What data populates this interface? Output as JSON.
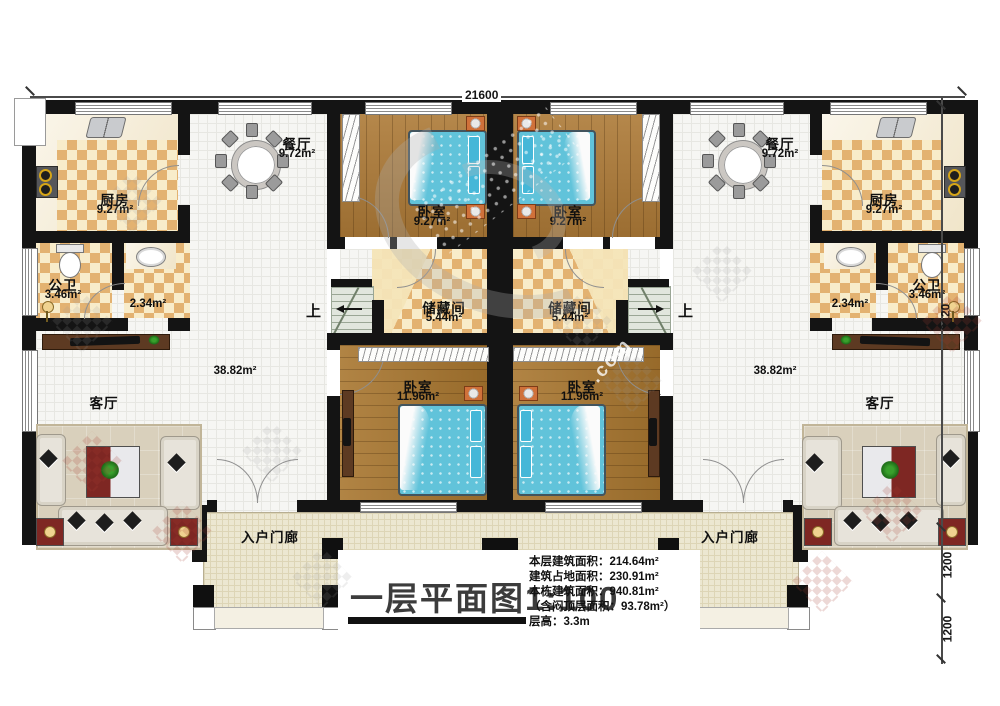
{
  "meta": {
    "title": "一层平面图1:100"
  },
  "dimensions": {
    "top": "21600",
    "side_main": "9120",
    "side_porch": "1200",
    "side_steps": "1200"
  },
  "stats": {
    "floor_area": "本层建筑面积：214.64m²",
    "footprint": "建筑占地面积：230.91m²",
    "building_total": "本栋建筑面积：940.81m²",
    "attic": "（含闷顶层面积：93.78m²）",
    "storey_height": "层高：3.3m"
  },
  "rooms": {
    "kitchen_l": {
      "name": "厨房",
      "area": "9.27m²"
    },
    "dining_l": {
      "name": "餐厅",
      "area": "9.72m²"
    },
    "bedroom_tl": {
      "name": "卧室",
      "area": "9.27m²"
    },
    "bath_l": {
      "name": "公卫",
      "area": "3.46m²"
    },
    "hall_l": {
      "area": "2.34m²"
    },
    "storage_l": {
      "name": "储藏间",
      "area": "5.44m²"
    },
    "bedroom_bl": {
      "name": "卧室",
      "area": "11.96m²"
    },
    "living_l": {
      "name": "客厅",
      "area": "38.82m²"
    },
    "porch_l": {
      "name": "入户门廊"
    },
    "bedroom_tr": {
      "name": "卧室",
      "area": "9.27m²"
    },
    "dining_r": {
      "name": "餐厅",
      "area": "9.72m²"
    },
    "kitchen_r": {
      "name": "厨房",
      "area": "9.27m²"
    },
    "storage_r": {
      "name": "储藏间",
      "area": "5.44m²"
    },
    "hall_r": {
      "area": "2.34m²"
    },
    "bath_r": {
      "name": "公卫",
      "area": "3.46m²"
    },
    "bedroom_br": {
      "name": "卧室",
      "area": "11.96m²"
    },
    "living_r": {
      "name": "客厅",
      "area": "38.82m²"
    },
    "porch_r": {
      "name": "入户门廊"
    }
  },
  "stairs": {
    "up_label": "上"
  },
  "watermark": {
    "fragment": ".com"
  }
}
